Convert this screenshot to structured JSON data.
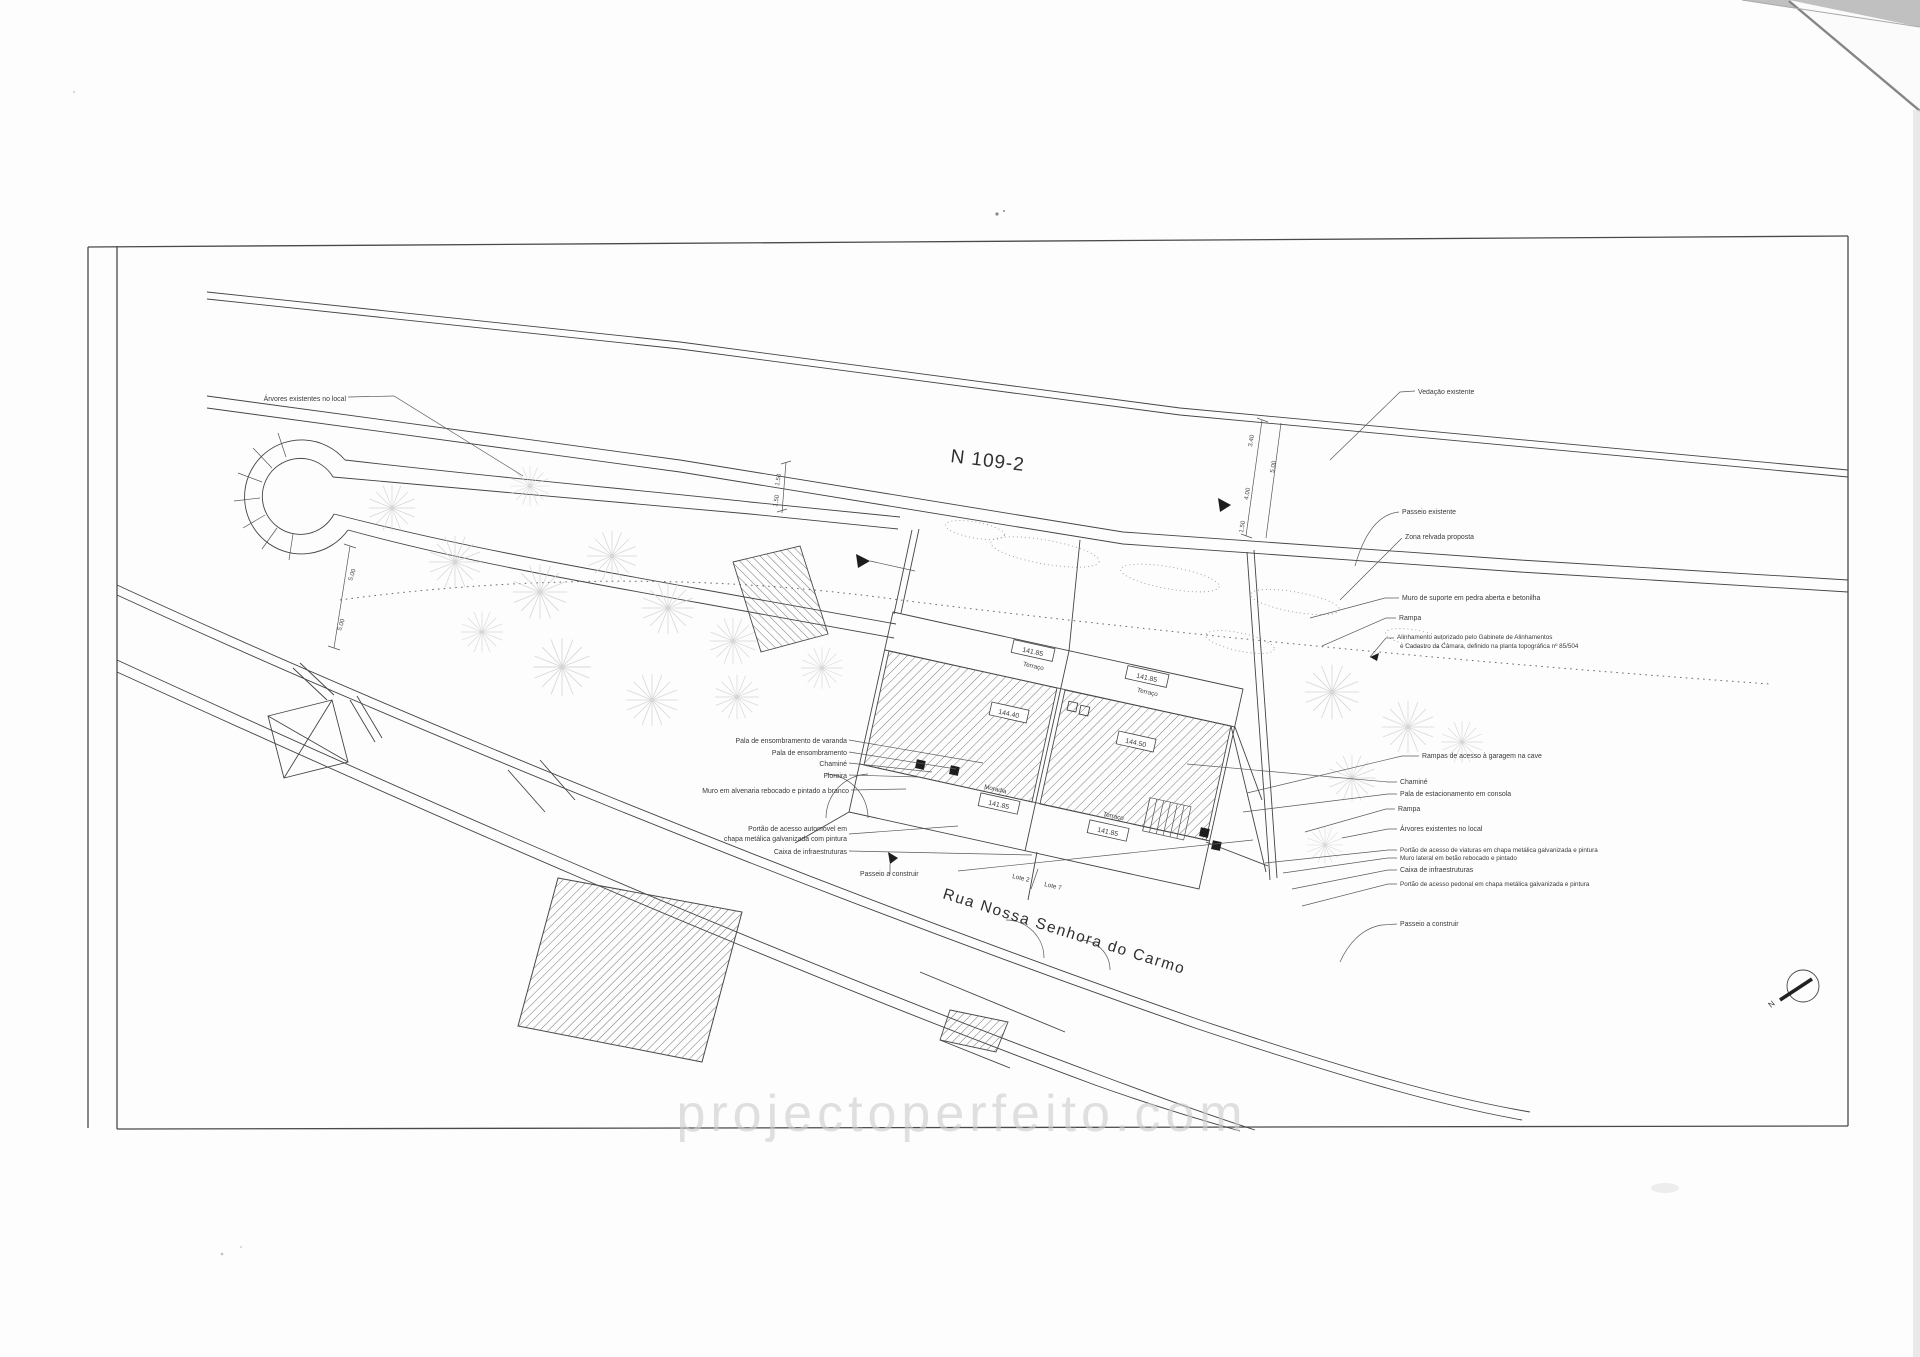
{
  "plan": {
    "title": "N 109-2",
    "street": "Rua Nossa Senhora do Carmo",
    "watermark": "projectoperfeito.com",
    "north": "N",
    "lots": [
      "Lote 2",
      "Lote 7"
    ],
    "levels": {
      "terrace_a": {
        "value": "141.85",
        "label": "Terraço"
      },
      "terrace_b": {
        "value": "141.85",
        "label": "Terraço"
      },
      "roof_left": "144.40",
      "roof_right": "144.50",
      "house": {
        "label": "Moradia",
        "value": "141.85"
      },
      "terrace_c": {
        "label": "Terraço",
        "value": "141.85"
      }
    },
    "dimensions": [
      "1.50",
      "1.50",
      "3.40",
      "5.00",
      "4.00",
      "1.50",
      "5.00",
      "5.00"
    ],
    "labels_left": [
      "Pala de ensombramento de varanda",
      "Pala de ensombramento",
      "Chaminé",
      "Floreira",
      "Muro em alvenaria rebocado e pintado a branco",
      "Portão de acesso automóvel em",
      "chapa metálica galvanizada com pintura",
      "Caixa de infraestruturas",
      "Passeio a construir",
      "Árvores existentes no local"
    ],
    "labels_right": [
      "Vedação existente",
      "Passeio existente",
      "Zona relvada proposta",
      "Muro de suporte em pedra aberta e betonilha",
      "Rampa",
      "Alinhamento autorizado pelo Gabinete de Alinhamentos",
      "e Cadastro da Câmara, definido na planta topográfica nº 85/504",
      "Rampas de acesso à garagem na cave",
      "Chaminé",
      "Pala de estacionamento em consola",
      "Rampa",
      "Árvores existentes no local",
      "Portão de acesso de viaturas em chapa metálica galvanizada e pintura",
      "Muro lateral em betão rebocado e pintado",
      "Caixa de infraestruturas",
      "Portão de acesso pedonal em chapa metálica galvanizada e pintura",
      "Passeio a construir"
    ]
  }
}
